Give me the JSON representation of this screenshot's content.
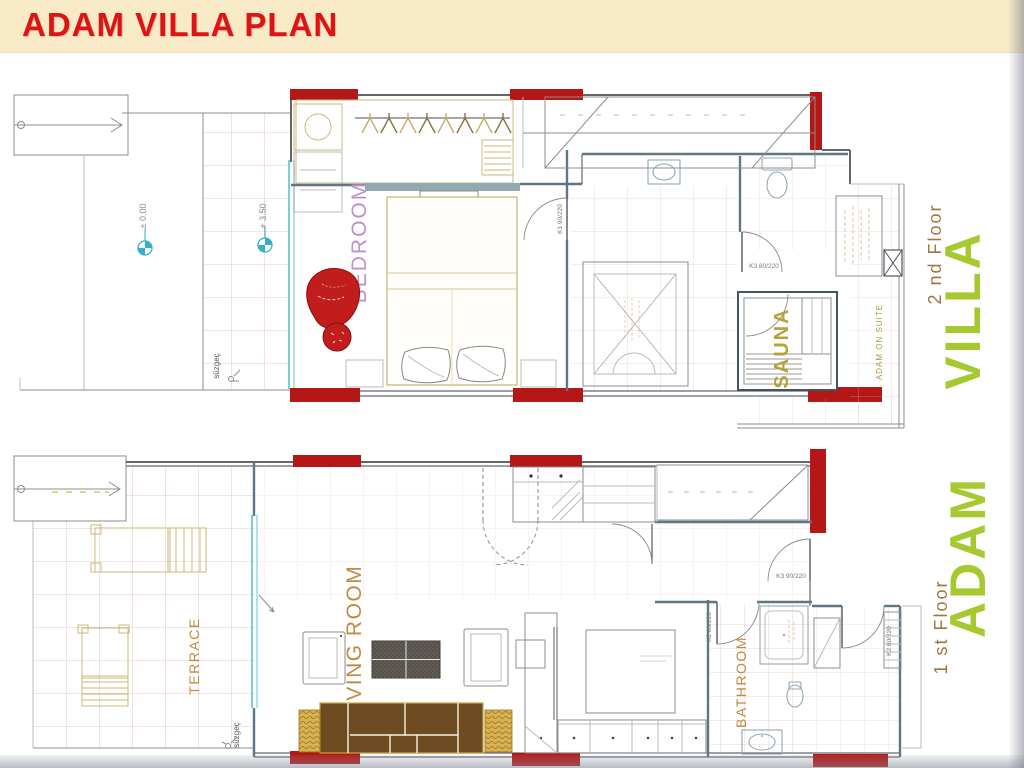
{
  "header": {
    "title": "ADAM VILLA PLAN"
  },
  "second_floor": {
    "floor_label": "2 nd Floor",
    "name_label": "VILLA",
    "bedroom_label": "BEDROOM",
    "sauna_label": "SAUNA",
    "suite_label": "ADAM ON SUITE",
    "door_bedroom": "K1 90/220",
    "door_wc": "K3 80/220",
    "level_ground": "± 0.00",
    "level_upper": "+ 3.50",
    "drain_label": "süzgeç"
  },
  "first_floor": {
    "floor_label": "1 st Floor",
    "name_label": "ADAM",
    "terrace_label": "TERRACE",
    "living_label": "LIVING ROOM",
    "bathroom_label": "BATHROOM",
    "door_hall": "K3 90/220",
    "door_bath": "K2 80/220",
    "door_closet": "K2 80/220",
    "drain_label": "süzgeç"
  },
  "colors": {
    "header_bg": "#F8EAC6",
    "title_red": "#DE1414",
    "wall_red": "#B51717",
    "brand_green": "#A5C92F",
    "floor_brown": "#A2743F",
    "room_orange": "#C08A42",
    "bedroom_purple": "#BD8FD0",
    "sauna_olive": "#B5A33A",
    "glazing_cyan": "#7CCFD6",
    "tile_pink": "#DFB6B6"
  }
}
